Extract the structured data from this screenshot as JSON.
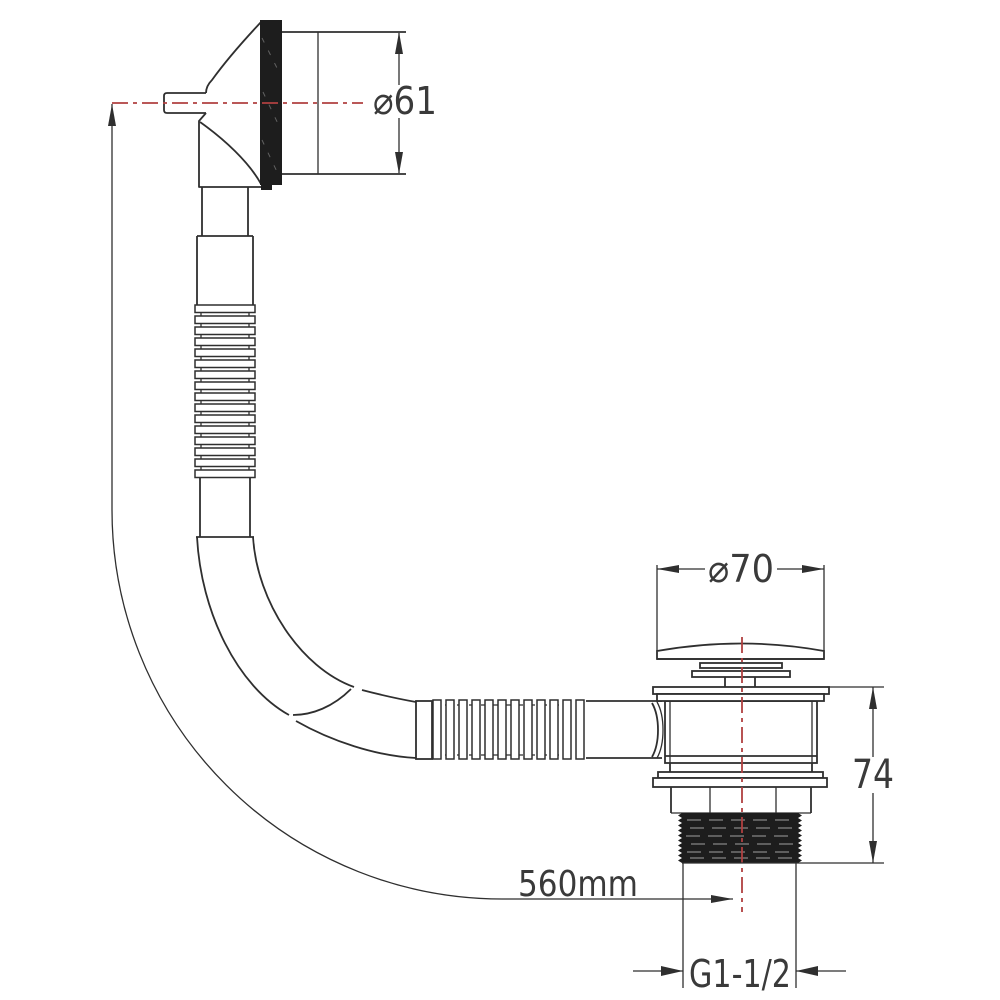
{
  "drawing": {
    "kind": "bath-overflow-filler-and-popup-waste-technical-drawing"
  },
  "dimensions": {
    "overflow_diameter": "⌀61",
    "plug_diameter": "⌀70",
    "body_height": "74",
    "hose_length": "560mm",
    "thread_size": "G1-1/2"
  },
  "colors": {
    "line": "#2f2f2f",
    "centerline_red": "#b04040",
    "background": "#ffffff"
  }
}
